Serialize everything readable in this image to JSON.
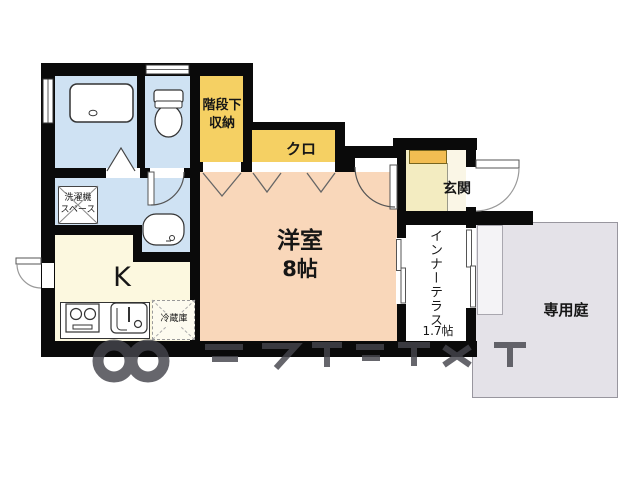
{
  "plan": {
    "rooms": {
      "western_room": {
        "name": "洋室",
        "area": "8帖"
      },
      "kitchen": {
        "name": "K"
      },
      "closet": {
        "name": "クロ"
      },
      "under_stairs_storage": {
        "name": "階段下収納",
        "lines": [
          "階段下",
          "収納"
        ]
      },
      "entrance": {
        "name": "玄関"
      },
      "inner_terrace": {
        "name": "インナーテラス",
        "area": "1.7帖"
      },
      "private_garden": {
        "name": "専用庭"
      },
      "laundry_space": {
        "name": "洗濯機スペース",
        "lines": [
          "洗濯機",
          "スペース"
        ]
      },
      "refrigerator_space": {
        "name": "冷蔵庫"
      }
    },
    "fixtures": [
      "bathtub",
      "toilet",
      "washbasin",
      "gas-stove",
      "kitchen-sink"
    ],
    "colors": {
      "wall": "#0a0a0a",
      "wet_area": "#cfe2f3",
      "storage_yellow": "#f5d063",
      "shoe_cabinet": "#f2bd52",
      "western_room": "#f9d7ba",
      "kitchen": "#fcf8df",
      "entrance": "#f3ecc1",
      "terrace": "#ffffff",
      "garden": "#e4e2e8"
    }
  }
}
